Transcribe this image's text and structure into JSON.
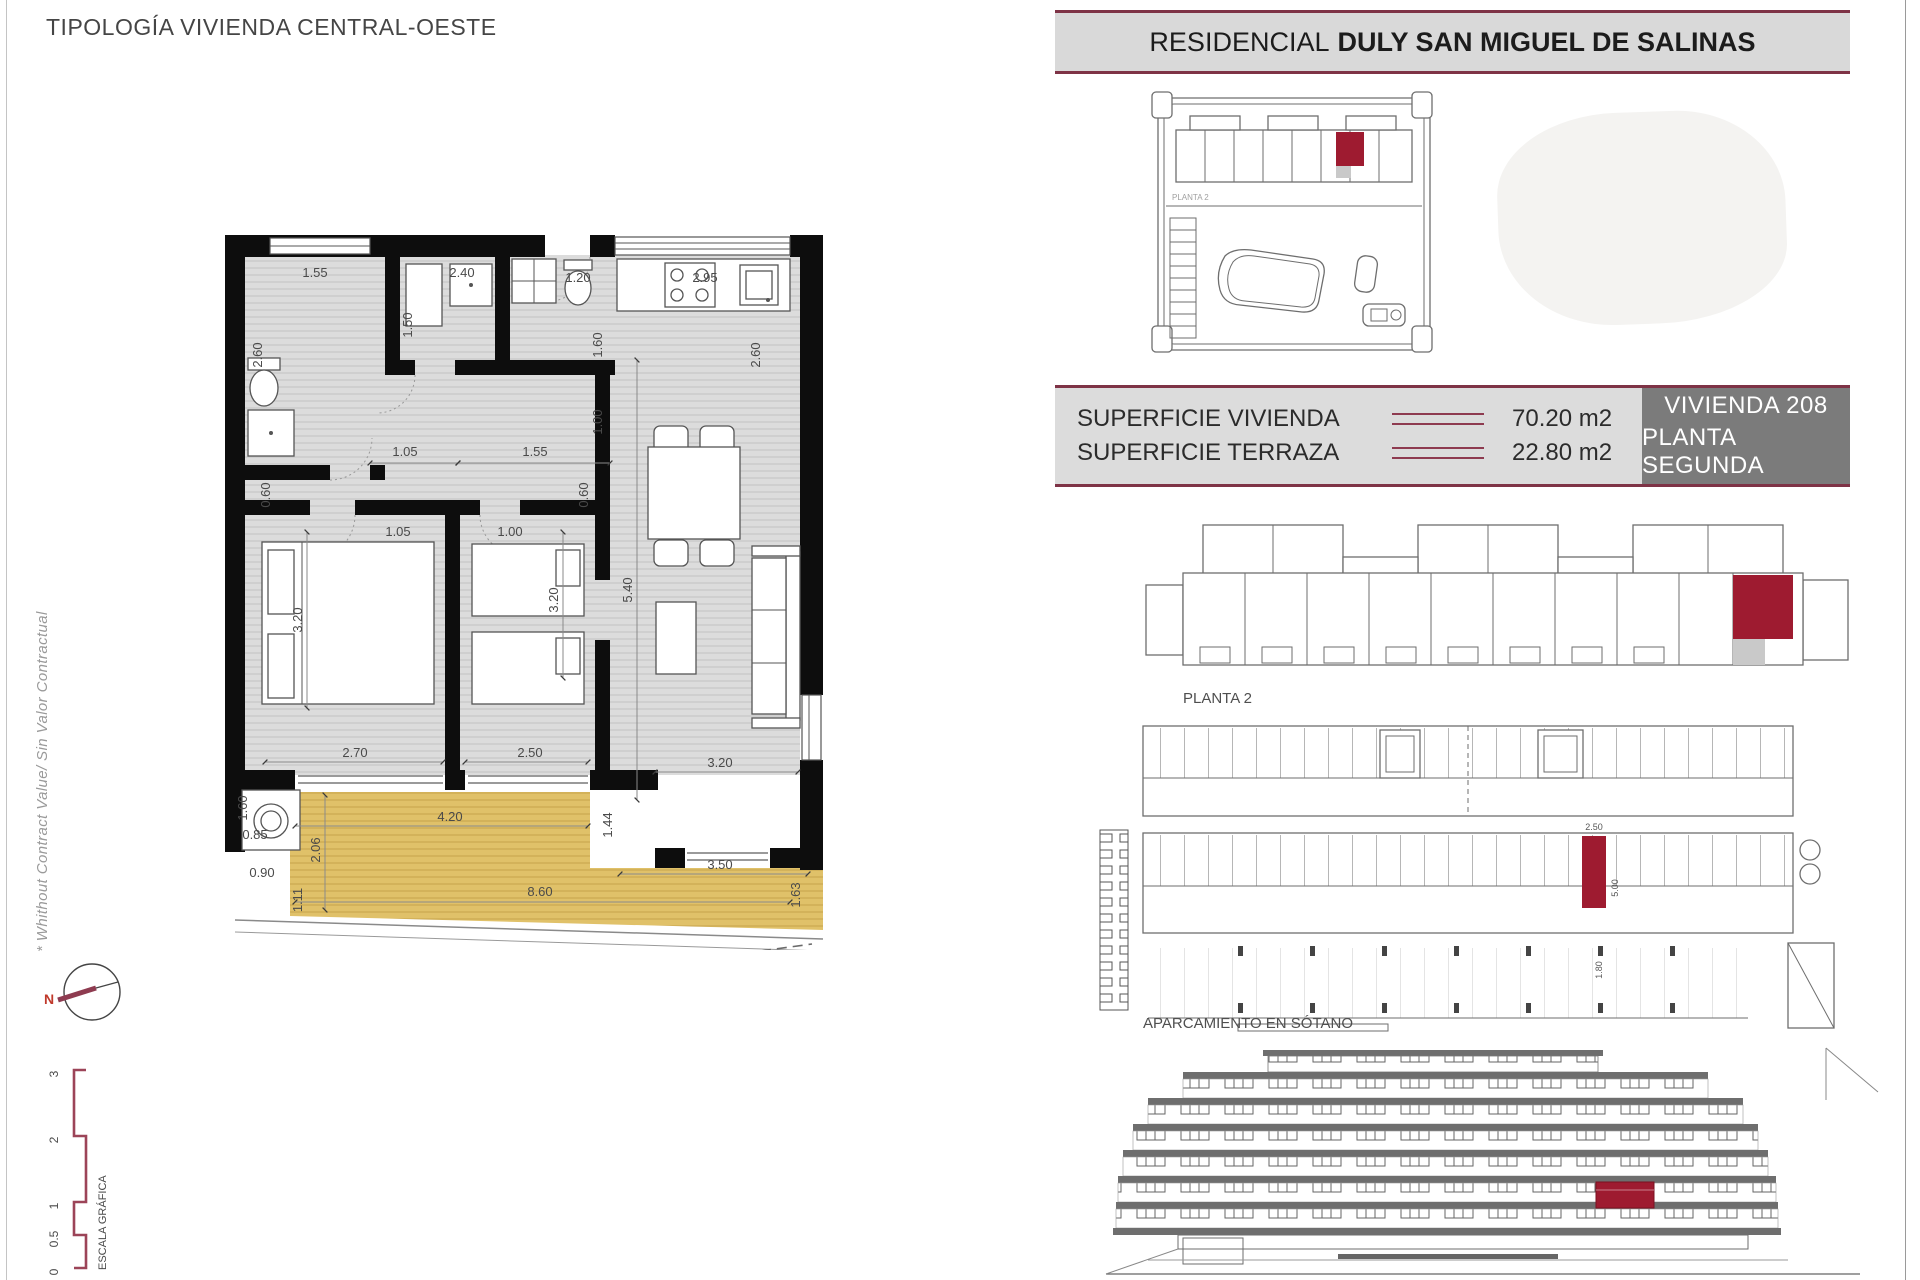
{
  "page": {
    "title": "TIPOLOGÍA VIVIENDA CENTRAL-OESTE",
    "side_note": "* Whithout Contract Value/ Sin Valor Contractual"
  },
  "header": {
    "prefix": "RESIDENCIAL",
    "name": "DULY SAN MIGUEL DE SALINAS"
  },
  "colors": {
    "accent_maroon": "#7e3346",
    "highlight_red": "#9e1b30",
    "terrace_yellow": "#e0c169",
    "panel_gray": "#dcdcdc",
    "unit_box_gray": "#7b7b7b"
  },
  "site_plan": {
    "tiny_label": "PLANTA 2"
  },
  "info_table": {
    "rows": [
      {
        "label": "SUPERFICIE VIVIENDA",
        "value": "70.20 m2"
      },
      {
        "label": "SUPERFICIE TERRAZA",
        "value": "22.80 m2"
      }
    ],
    "unit_lines": [
      "VIVIENDA 208",
      "PLANTA SEGUNDA"
    ]
  },
  "planta2": {
    "label": "PLANTA 2"
  },
  "parking": {
    "label": "APARCAMIENTO EN SÓTANO",
    "dims": [
      {
        "t": "2.50",
        "x": 506,
        "y": 112
      },
      {
        "t": "5.00",
        "x": 530,
        "y": 170,
        "r": -90
      },
      {
        "t": "1.80",
        "x": 514,
        "y": 252,
        "r": -90
      }
    ]
  },
  "compass": {
    "label": "N"
  },
  "scale_bar": {
    "label": "ESCALA GRÁFICA",
    "ticks": [
      {
        "t": "3",
        "x": 30,
        "y": 16,
        "r": -90
      },
      {
        "t": "2",
        "x": 30,
        "y": 82,
        "r": -90
      },
      {
        "t": "1",
        "x": 30,
        "y": 148,
        "r": -90
      },
      {
        "t": "0.5",
        "x": 30,
        "y": 181,
        "r": -90
      },
      {
        "t": "0",
        "x": 30,
        "y": 214,
        "r": -90
      }
    ]
  },
  "floorplan": {
    "dims": [
      {
        "t": "1.55",
        "x": 165,
        "y": 117
      },
      {
        "t": "2.40",
        "x": 312,
        "y": 117
      },
      {
        "t": "1.20",
        "x": 428,
        "y": 122
      },
      {
        "t": "2.95",
        "x": 555,
        "y": 122
      },
      {
        "t": "2.60",
        "x": 112,
        "y": 195,
        "r": -90
      },
      {
        "t": "1.50",
        "x": 262,
        "y": 165,
        "r": -90
      },
      {
        "t": "1.60",
        "x": 452,
        "y": 185,
        "r": -90
      },
      {
        "t": "1.00",
        "x": 452,
        "y": 262,
        "r": -90
      },
      {
        "t": "2.60",
        "x": 610,
        "y": 195,
        "r": -90
      },
      {
        "t": "1.05",
        "x": 255,
        "y": 296
      },
      {
        "t": "1.55",
        "x": 385,
        "y": 296
      },
      {
        "t": "0.60",
        "x": 120,
        "y": 335,
        "r": -90
      },
      {
        "t": "0.60",
        "x": 438,
        "y": 335,
        "r": -90
      },
      {
        "t": "1.05",
        "x": 248,
        "y": 376
      },
      {
        "t": "1.00",
        "x": 360,
        "y": 376
      },
      {
        "t": "3.20",
        "x": 152,
        "y": 460,
        "r": -90
      },
      {
        "t": "3.20",
        "x": 408,
        "y": 440,
        "r": -90
      },
      {
        "t": "5.40",
        "x": 482,
        "y": 430,
        "r": -90
      },
      {
        "t": "2.70",
        "x": 205,
        "y": 597
      },
      {
        "t": "2.50",
        "x": 380,
        "y": 597
      },
      {
        "t": "3.20",
        "x": 570,
        "y": 607
      },
      {
        "t": "4.20",
        "x": 300,
        "y": 661
      },
      {
        "t": "2.06",
        "x": 170,
        "y": 690,
        "r": -90
      },
      {
        "t": "1.44",
        "x": 462,
        "y": 665,
        "r": -90
      },
      {
        "t": "1.60",
        "x": 97,
        "y": 648,
        "r": -90
      },
      {
        "t": "0.85",
        "x": 105,
        "y": 679
      },
      {
        "t": "0.90",
        "x": 112,
        "y": 717
      },
      {
        "t": "1.11",
        "x": 152,
        "y": 740,
        "r": -90
      },
      {
        "t": "8.60",
        "x": 390,
        "y": 736
      },
      {
        "t": "3.50",
        "x": 570,
        "y": 709
      },
      {
        "t": "1.63",
        "x": 650,
        "y": 735,
        "r": -90
      }
    ]
  }
}
